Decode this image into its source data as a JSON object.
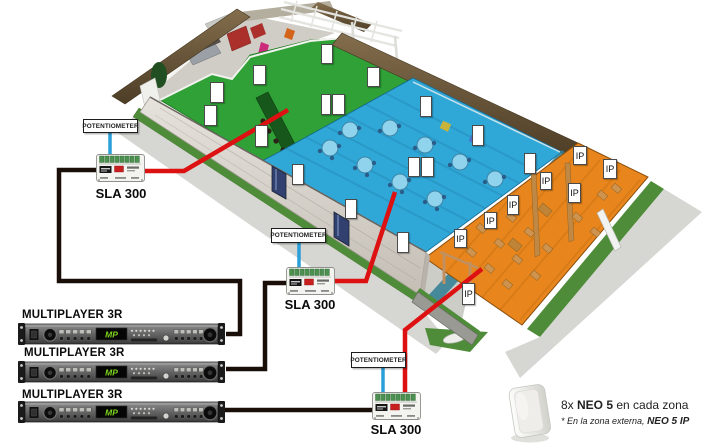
{
  "device_labels": {
    "sla": "SLA 300",
    "potentiometer": "POTENTIOMETER",
    "multiplayer": "MULTIPLAYER 3R",
    "rack_logo": "MP"
  },
  "note": {
    "line1_prefix": "8x ",
    "line1_bold": "NEO 5",
    "line1_suffix": " en cada zona",
    "line2_prefix": "* En la zona externa, ",
    "line2_bold": "NEO 5 IP"
  },
  "speakers": {
    "ip_label": "IP",
    "plain_boxes": [
      {
        "x": 321,
        "y": 44,
        "w": 12,
        "h": 20
      },
      {
        "x": 253,
        "y": 65,
        "w": 13,
        "h": 20
      },
      {
        "x": 210,
        "y": 82,
        "w": 14,
        "h": 21
      },
      {
        "x": 321,
        "y": 94,
        "w": 10,
        "h": 21
      },
      {
        "x": 332,
        "y": 94,
        "w": 13,
        "h": 21
      },
      {
        "x": 204,
        "y": 105,
        "w": 13,
        "h": 21
      },
      {
        "x": 255,
        "y": 125,
        "w": 13,
        "h": 22
      },
      {
        "x": 292,
        "y": 164,
        "w": 12,
        "h": 21
      },
      {
        "x": 367,
        "y": 67,
        "w": 13,
        "h": 20
      },
      {
        "x": 420,
        "y": 96,
        "w": 12,
        "h": 21
      },
      {
        "x": 472,
        "y": 125,
        "w": 12,
        "h": 21
      },
      {
        "x": 408,
        "y": 157,
        "w": 12,
        "h": 20
      },
      {
        "x": 421,
        "y": 157,
        "w": 13,
        "h": 20
      },
      {
        "x": 524,
        "y": 153,
        "w": 12,
        "h": 21
      },
      {
        "x": 345,
        "y": 199,
        "w": 12,
        "h": 20
      },
      {
        "x": 397,
        "y": 232,
        "w": 12,
        "h": 21
      }
    ],
    "ip_boxes": [
      {
        "x": 573,
        "y": 146,
        "w": 14,
        "h": 19
      },
      {
        "x": 603,
        "y": 159,
        "w": 14,
        "h": 20
      },
      {
        "x": 540,
        "y": 172,
        "w": 12,
        "h": 18
      },
      {
        "x": 568,
        "y": 183,
        "w": 13,
        "h": 20
      },
      {
        "x": 507,
        "y": 195,
        "w": 12,
        "h": 20
      },
      {
        "x": 484,
        "y": 212,
        "w": 13,
        "h": 17
      },
      {
        "x": 454,
        "y": 229,
        "w": 13,
        "h": 19
      },
      {
        "x": 462,
        "y": 283,
        "w": 13,
        "h": 22
      }
    ]
  },
  "zones": [
    {
      "id": "zone-1-interior",
      "color_key": "zone_green"
    },
    {
      "id": "zone-2-interior",
      "color_key": "zone_blue"
    },
    {
      "id": "zone-3-exterior",
      "color_key": "zone_orange"
    }
  ],
  "colors": {
    "zone_green": "#2fa136",
    "zone_blue": "#2fa8d8",
    "zone_orange": "#e8861d",
    "wire_red": "#dd1111",
    "wire_black": "#1a0e08",
    "wire_blue": "#2b9fd8",
    "hedge_brown": "#6e5b40",
    "grass_green": "#4f8c3a",
    "sidewalk_gray": "#d6d6d2",
    "wall_gray": "#ddd9d3"
  }
}
